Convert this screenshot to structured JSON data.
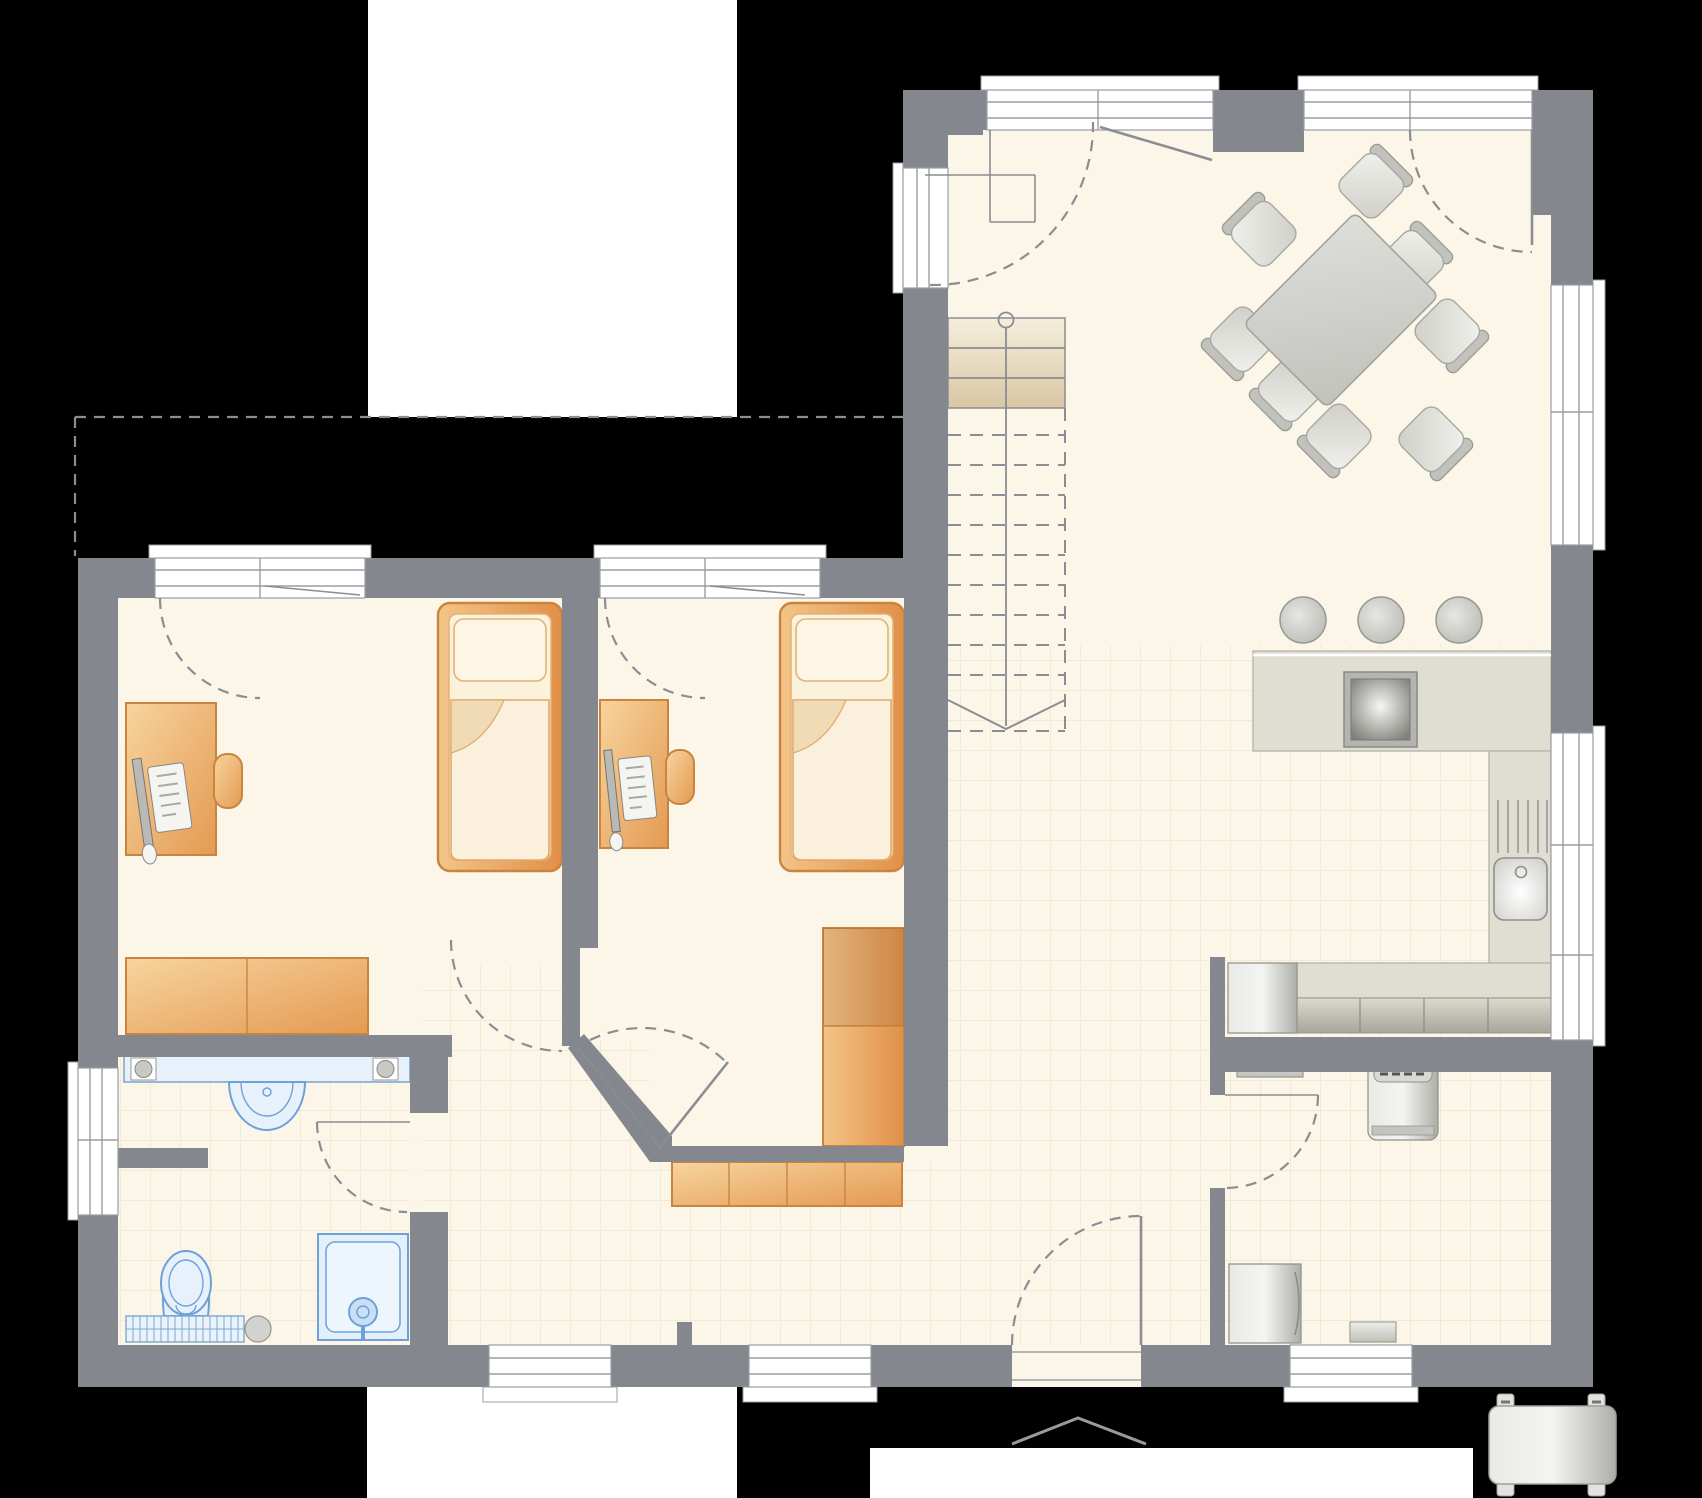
{
  "canvas": {
    "width": 1702,
    "height": 1498
  },
  "palette": {
    "bg": "#000000",
    "exterior": "#ffffff",
    "wall": "#84878d",
    "floor": "#fbf6e8",
    "tile": "#efe6cf",
    "counter": "#e0ddd2",
    "counterline": "#b9b6aa",
    "line": "#8a8d92",
    "frame": "#9a9da2",
    "wood1": "#f6ce96",
    "wood2": "#e9a25b",
    "woodborder": "#c9853f",
    "bedinner": "#fbf2dc",
    "fixfill": "#e3effb",
    "fixline": "#6fa1d8",
    "stair1": "#f5eedd",
    "stair2": "#e2d2b0",
    "gray1": "#ededea",
    "gray2": "#c6c6c1"
  },
  "plan": {
    "type": "residential-ground-floor-plan",
    "rooms": [
      {
        "id": "living-dining",
        "features": [
          "dining-table",
          "dining-chairs-x8",
          "entry-screen",
          "terrace-doors"
        ]
      },
      {
        "id": "kitchen",
        "features": [
          "breakfast-bar",
          "bar-stools-x3",
          "cooktop",
          "sink-with-drainer",
          "tall-cabinet-row",
          "oven-block"
        ]
      },
      {
        "id": "stair-hall",
        "features": [
          "staircase",
          "newel-circle",
          "direction-arrow"
        ]
      },
      {
        "id": "bedroom-left",
        "features": [
          "single-bed",
          "desk-with-computer",
          "desk-chair",
          "sideboard",
          "french-window"
        ]
      },
      {
        "id": "bedroom-middle",
        "features": [
          "single-bed",
          "desk-with-computer",
          "desk-chair",
          "wardrobe",
          "french-window",
          "diagonal-corner-door"
        ]
      },
      {
        "id": "bathroom",
        "features": [
          "vanity-counter",
          "washbasin",
          "toilet",
          "shower",
          "radiator"
        ]
      },
      {
        "id": "utility-room",
        "features": [
          "washing-machine",
          "wall-cabinet",
          "freezer"
        ]
      },
      {
        "id": "entrance-hall",
        "features": [
          "entrance-door",
          "shoe-cabinet",
          "porch-canopy"
        ]
      }
    ],
    "exterior_objects": [
      "garage-block",
      "carport-dashed-outline",
      "patio-block",
      "driveway-strip",
      "parked-car"
    ],
    "counts": {
      "dining_chairs": 8,
      "bar_stools": 3,
      "beds": 2,
      "desks": 2,
      "visible_stair_treads": 3,
      "dashed_stair_treads": 10
    }
  }
}
